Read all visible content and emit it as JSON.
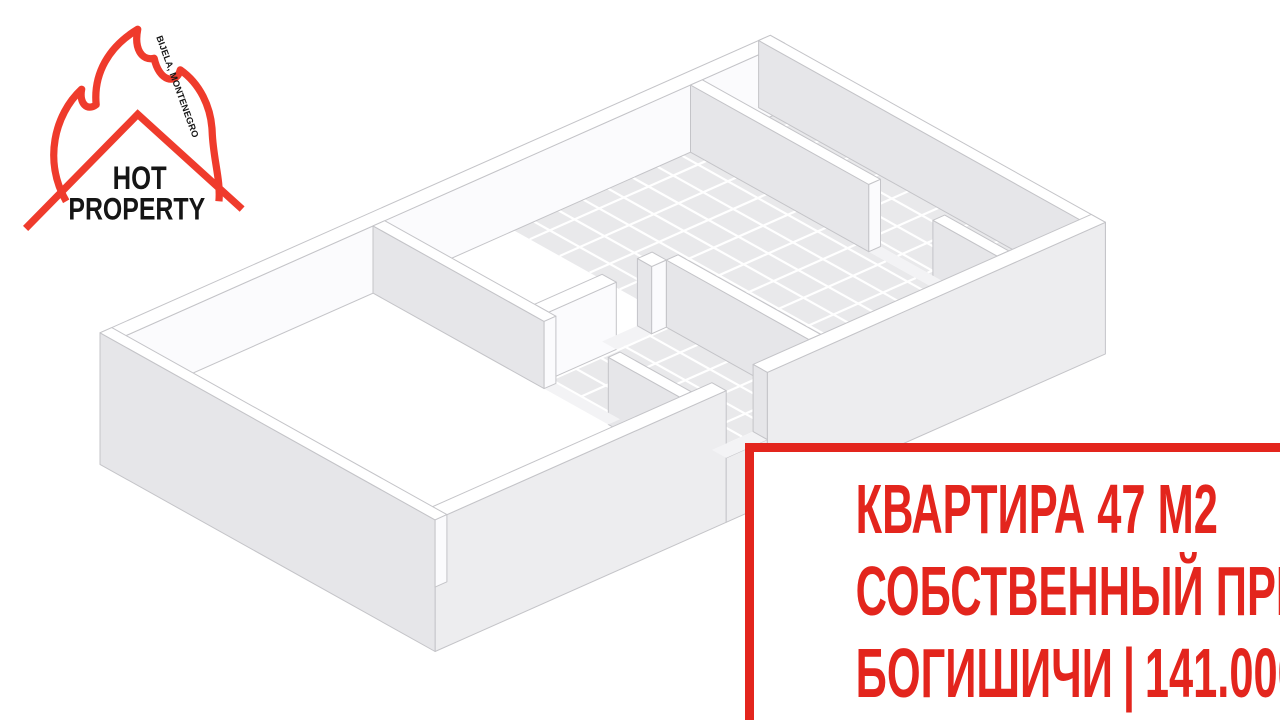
{
  "page": {
    "background": "#ffffff"
  },
  "logo": {
    "title_line1": "HOT",
    "title_line2": "PROPERTY",
    "tagline": "BIJELA, MONTENEGRO",
    "flame_color": "#ef3b2c",
    "text_color": "#151515"
  },
  "info_box": {
    "accent_color": "#e3251d",
    "line1": "КВАРТИРА 47 М2",
    "line2": "СОБСТВЕННЫЙ ПРИЧАЛ",
    "line3_location": "БОГИШИЧИ",
    "line3_divider": "|",
    "line3_price": "141.000 €"
  },
  "floor_plan_colors": {
    "wall_face": "#e6e6e9",
    "wall_light": "#fbfbfd",
    "wall_top": "#ffffff",
    "slab_front": "#ededef",
    "floor": "#ffffff",
    "tile": "#e9e9eb",
    "grout": "#ffffff",
    "sill": "#f3f3f5",
    "line": "#c4c4c8"
  }
}
